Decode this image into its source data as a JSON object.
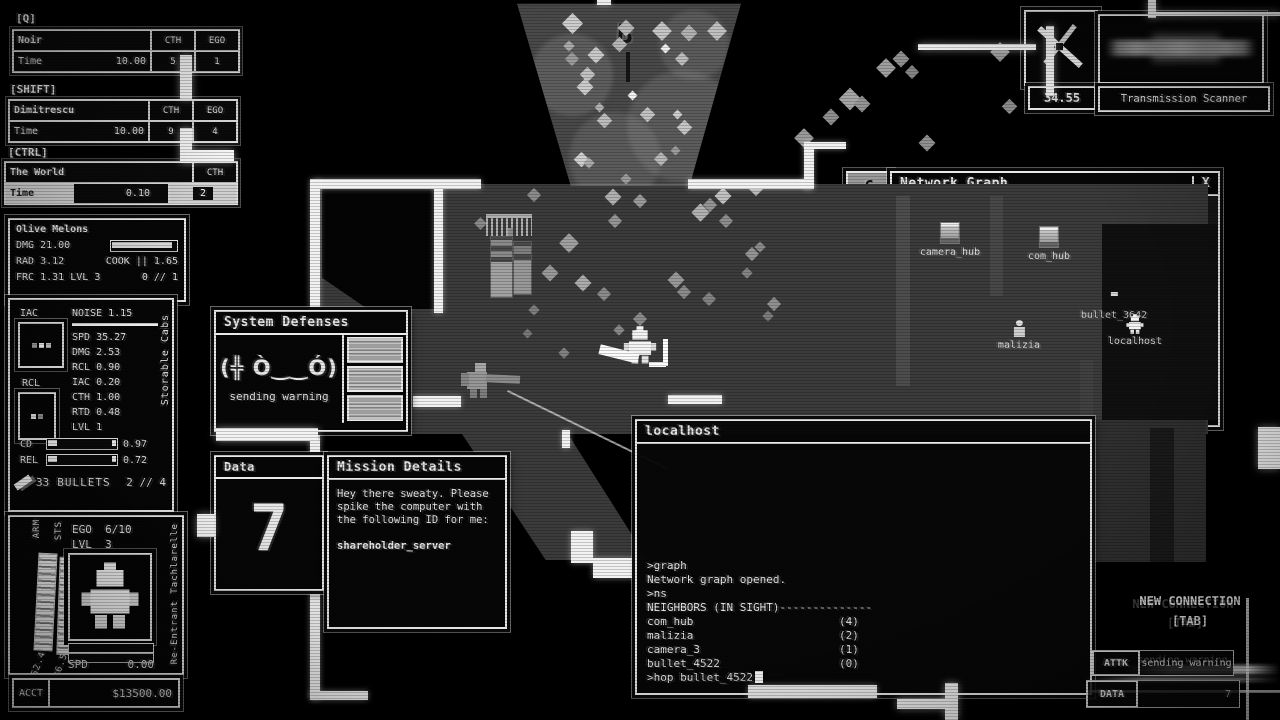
{
  "hud": {
    "abilities": [
      {
        "key": "[Q]",
        "name": "Noir",
        "col1": "CTH",
        "col2": "EGO",
        "time_label": "Time",
        "time": "10.00",
        "v1": "5",
        "v2": "1"
      },
      {
        "key": "[SHIFT]",
        "name": "Dimitrescu",
        "col1": "CTH",
        "col2": "EGO",
        "time_label": "Time",
        "time": "10.00",
        "v1": "9",
        "v2": "4"
      },
      {
        "key": "[CTRL]",
        "name": "The World",
        "col1": "CTH",
        "time_label": "Time",
        "time": "0.10",
        "v1": "2"
      }
    ],
    "weapon": {
      "name": "Olive Melons",
      "dmg_label": "DMG",
      "dmg": "21.00",
      "rad_label": "RAD",
      "rad": "3.12",
      "cook_label": "COOK ||",
      "cook": "1.65",
      "frc_label": "FRC",
      "frc": "1.31",
      "lvl_label": "LVL",
      "lvl": "3",
      "ammo": "0 // 1"
    },
    "stats": {
      "slot1_label": "IAC",
      "slot2_label": "RCL",
      "noise_label": "NOISE",
      "noise": "1.15",
      "rows": [
        {
          "label": "SPD",
          "value": "35.27"
        },
        {
          "label": "DMG",
          "value": "2.53"
        },
        {
          "label": "RCL",
          "value": "0.90"
        },
        {
          "label": "IAC",
          "value": "0.20"
        },
        {
          "label": "CTH",
          "value": "1.00"
        },
        {
          "label": "RTD",
          "value": "0.48"
        },
        {
          "label": "LVL",
          "value": "1"
        }
      ],
      "cd_label": "CD",
      "cd": "0.97",
      "rel_label": "REL",
      "rel": "0.72",
      "bullets_count": "33",
      "bullets_label": "BULLETS",
      "bullets_mag": "2 // 4",
      "side_label": "Storable Cabs"
    },
    "player": {
      "arm_label": "ARM",
      "arm": "62.4",
      "sts_label": "STS",
      "sts": "36.5",
      "ego_label": "EGO",
      "ego": "6/10",
      "lvl_label": "LVL",
      "lvl": "3",
      "spd_label": "SPD",
      "spd": "0.00",
      "acct_label": "ACCT",
      "acct": "$13500.00",
      "side_label": "Re-Entrant Tachlarelle"
    }
  },
  "system_defenses": {
    "title": "System Defenses",
    "emote": "(╬ Ò‿‿Ó)",
    "status": "sending warning"
  },
  "data_panel": {
    "title": "Data",
    "value": "7"
  },
  "mission": {
    "title": "Mission Details",
    "body": "Hey there sweaty. Please spike the computer with the following ID for me:",
    "target": "shareholder_server"
  },
  "network_graph": {
    "collapse_label": "C",
    "title": "Network Graph",
    "close_label": "X",
    "zoom": "3.7X",
    "nodes": [
      {
        "name": "camera_hub"
      },
      {
        "name": "com_hub"
      },
      {
        "name": "bullet_3642"
      },
      {
        "name": "malizia"
      },
      {
        "name": "localhost"
      }
    ]
  },
  "terminal": {
    "title": "localhost",
    "history": [
      ">graph",
      "Network graph opened.",
      ">ns",
      "NEIGHBORS (IN SIGHT)--------------"
    ],
    "neighbors": [
      {
        "name": "com_hub",
        "count": "(4)"
      },
      {
        "name": "malizia",
        "count": "(2)"
      },
      {
        "name": "camera_3",
        "count": "(1)"
      },
      {
        "name": "bullet_4522",
        "count": "(0)"
      }
    ],
    "prompt": ">hop bullet_4522"
  },
  "scanner": {
    "value": "34.55",
    "label": "Transmission Scanner"
  },
  "connection": {
    "title": "NEW CONNECTION",
    "key_hint": "[TAB]",
    "attk_label": "ATTK",
    "attk_status": "sending warning",
    "data_label": "DATA",
    "data_value": "7"
  },
  "map": {
    "cone_glyph": "B",
    "diamonds": [
      [
        565,
        16,
        15,
        "#cdcdcd"
      ],
      [
        620,
        22,
        12,
        "#b8b8b8"
      ],
      [
        655,
        24,
        14,
        "#c6c6c6"
      ],
      [
        683,
        27,
        12,
        "#b2b2b2"
      ],
      [
        710,
        24,
        14,
        "#c0c0c0"
      ],
      [
        590,
        49,
        12,
        "#c9c9c9"
      ],
      [
        565,
        42,
        8,
        "#ababab"
      ],
      [
        567,
        54,
        10,
        "#9c9c9c"
      ],
      [
        614,
        39,
        11,
        "#b6b6b6"
      ],
      [
        582,
        69,
        11,
        "#c2c2c2"
      ],
      [
        579,
        81,
        12,
        "#cccccc"
      ],
      [
        662,
        45,
        7,
        "#efefef"
      ],
      [
        677,
        54,
        10,
        "#bdbdbd"
      ],
      [
        629,
        92,
        7,
        "#f2f2f2"
      ],
      [
        642,
        109,
        11,
        "#c2c2c2"
      ],
      [
        596,
        104,
        7,
        "#b2b2b2"
      ],
      [
        599,
        115,
        11,
        "#bdbdbd"
      ],
      [
        674,
        111,
        7,
        "#cfcfcf"
      ],
      [
        679,
        122,
        11,
        "#c6c6c6"
      ],
      [
        576,
        154,
        11,
        "#d0d0d0"
      ],
      [
        585,
        159,
        8,
        "#ababab"
      ],
      [
        622,
        175,
        8,
        "#9c9c9c"
      ],
      [
        656,
        154,
        10,
        "#b8b8b8"
      ],
      [
        672,
        147,
        7,
        "#9c9c9c"
      ],
      [
        797,
        131,
        14,
        "#9a9a9a"
      ],
      [
        825,
        111,
        12,
        "#8f8f8f"
      ],
      [
        842,
        91,
        16,
        "#a6a6a6"
      ],
      [
        856,
        98,
        12,
        "#959595"
      ],
      [
        879,
        61,
        14,
        "#9f9f9f"
      ],
      [
        895,
        53,
        12,
        "#919191"
      ],
      [
        907,
        67,
        10,
        "#868686"
      ],
      [
        993,
        45,
        14,
        "#9d9d9d"
      ],
      [
        1004,
        101,
        11,
        "#8b8b8b"
      ],
      [
        921,
        137,
        12,
        "#909090"
      ],
      [
        607,
        191,
        12,
        "#b1b1b1"
      ],
      [
        635,
        196,
        10,
        "#9b9b9b"
      ],
      [
        717,
        190,
        12,
        "#c1c1c1"
      ],
      [
        751,
        184,
        10,
        "#b6b6b6"
      ],
      [
        694,
        206,
        13,
        "#b3b3b3"
      ],
      [
        705,
        200,
        10,
        "#959595"
      ],
      [
        721,
        216,
        10,
        "#8e8e8e"
      ],
      [
        529,
        190,
        10,
        "#8b8b8b"
      ],
      [
        562,
        236,
        14,
        "#a1a1a1"
      ],
      [
        610,
        216,
        10,
        "#959595"
      ],
      [
        544,
        267,
        12,
        "#9a9a9a"
      ],
      [
        577,
        277,
        12,
        "#acacac"
      ],
      [
        599,
        289,
        10,
        "#8b8b8b"
      ],
      [
        530,
        306,
        8,
        "#7e7e7e"
      ],
      [
        635,
        314,
        10,
        "#8b8b8b"
      ],
      [
        670,
        274,
        12,
        "#9a9a9a"
      ],
      [
        679,
        287,
        10,
        "#8b8b8b"
      ],
      [
        704,
        294,
        10,
        "#838383"
      ],
      [
        747,
        249,
        10,
        "#969696"
      ],
      [
        756,
        243,
        8,
        "#8b8b8b"
      ],
      [
        743,
        269,
        8,
        "#848484"
      ],
      [
        769,
        299,
        10,
        "#919191"
      ],
      [
        764,
        312,
        8,
        "#7b7b7b"
      ],
      [
        615,
        326,
        8,
        "#898989"
      ],
      [
        633,
        330,
        8,
        "#959595"
      ],
      [
        494,
        247,
        12,
        "#9b9b9b"
      ],
      [
        476,
        219,
        9,
        "#8a8a8a"
      ],
      [
        524,
        330,
        7,
        "#787878"
      ],
      [
        560,
        349,
        8,
        "#818181"
      ]
    ]
  }
}
